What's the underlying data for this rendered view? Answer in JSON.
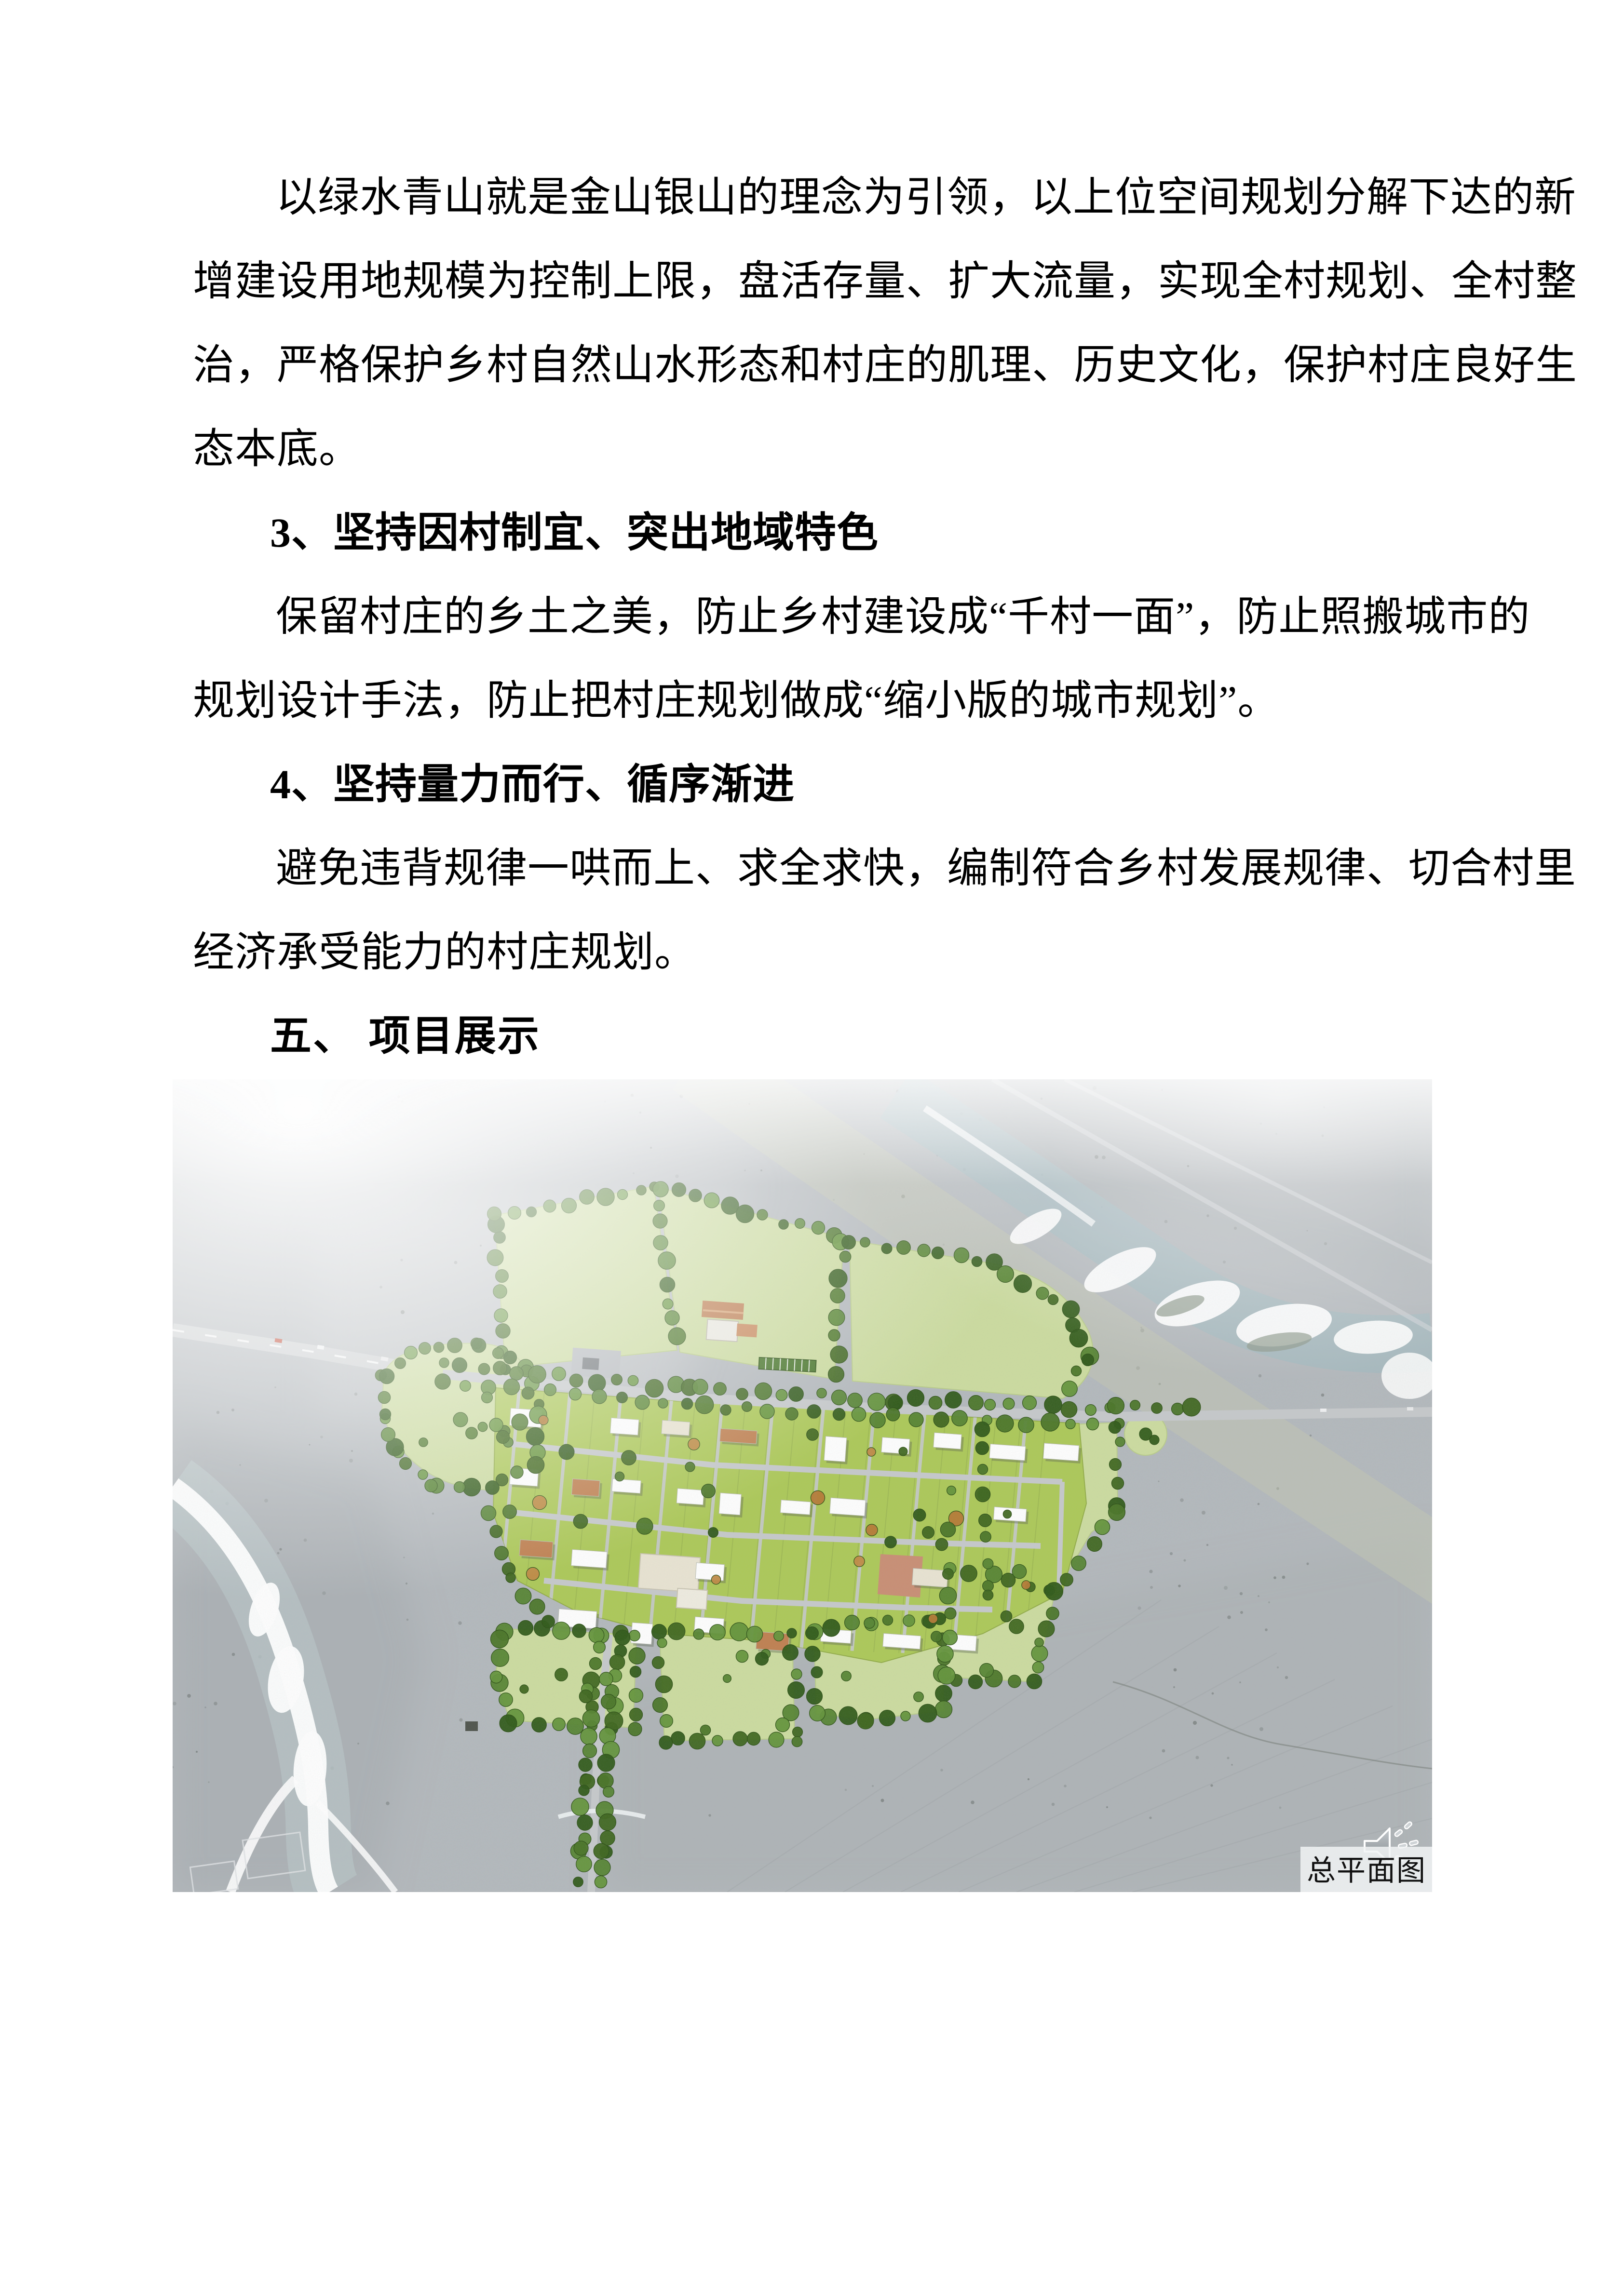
{
  "document": {
    "lines": [
      {
        "text": "以绿水青山就是金山银山的理念为引领，以上位空间规划分解下达的新"
      },
      {
        "text": "增建设用地规模为控制上限，盘活存量、扩大流量，实现全村规划、全村整"
      },
      {
        "text": "治，严格保护乡村自然山水形态和村庄的肌理、历史文化，保护村庄良好生"
      },
      {
        "text": "态本底。"
      },
      {
        "text": "3、坚持因村制宜、突出地域特色"
      },
      {
        "text": "保留村庄的乡土之美，防止乡村建设成“千村一面”，防止照搬城市的"
      },
      {
        "text": "规划设计手法，防止把村庄规划做成“缩小版的城市规划”。"
      },
      {
        "text": "4、坚持量力而行、循序渐进"
      },
      {
        "text": "避免违背规律一哄而上、求全求快，编制符合乡村发展规律、切合村里"
      },
      {
        "text": "经济承受能力的村庄规划。"
      },
      {
        "text": "五、 项目展示"
      }
    ]
  },
  "figure": {
    "caption": "总平面图",
    "icon": "speaker-icon",
    "palette": {
      "terrain": "#b4b9bd",
      "field_green": "#ccdc9f",
      "parcel_green": "#adc958",
      "tree_green": "#4e7d2a",
      "road_gray": "#c9ccce",
      "river_white": "#ffffff",
      "roof_white": "#ffffff",
      "roof_orange": "#c08050",
      "caption_bg": "#f1f3f5",
      "caption_text": "#111111"
    }
  }
}
